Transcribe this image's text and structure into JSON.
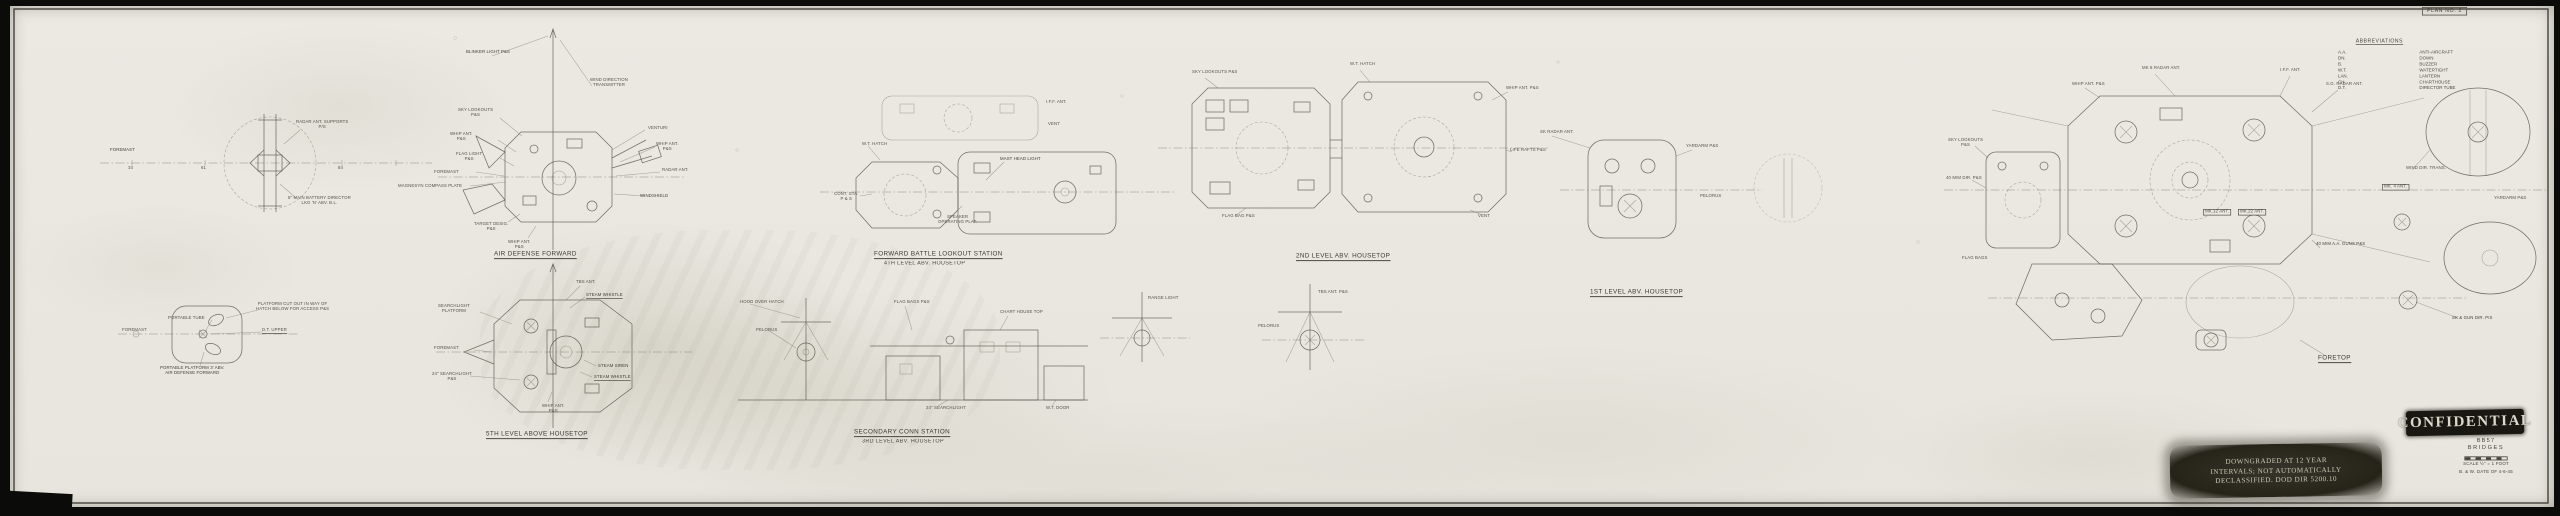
{
  "sheet": {
    "plan_no": "PLAN NO. 2"
  },
  "abbreviations": {
    "title": "ABBREVIATIONS",
    "rows": [
      {
        "abbr": "A.A.",
        "meaning": "ANTI-AIRCRAFT"
      },
      {
        "abbr": "DN.",
        "meaning": "DOWN"
      },
      {
        "abbr": "B.",
        "meaning": "BUZZER"
      },
      {
        "abbr": "W.T.",
        "meaning": "WATERTIGHT"
      },
      {
        "abbr": "LAN.",
        "meaning": "LANTERN"
      },
      {
        "abbr": "CH.",
        "meaning": "CHARTHOUSE"
      },
      {
        "abbr": "D.T.",
        "meaning": "DIRECTOR TUBE"
      }
    ]
  },
  "stamps": {
    "confidential": "CONFIDENTIAL",
    "downgraded_line1": "DOWNGRADED AT 12 YEAR",
    "downgraded_line2": "INTERVALS; NOT AUTOMATICALLY",
    "downgraded_line3": "DECLASSIFIED. DOD DIR 5200.10"
  },
  "title_block": {
    "ship": "BB57",
    "drawing_title": "BRIDGES",
    "scale_note": "SCALE ½\" = 1 FOOT",
    "date_note": "B. & W. DATE OF 4-6-45"
  },
  "sections": {
    "s1": "AIR DEFENSE FORWARD",
    "s2": "FORWARD BATTLE LOOKOUT STATION",
    "s2b": "4TH LEVEL ABV. HOUSETOP",
    "s3": "2ND LEVEL ABV. HOUSETOP",
    "s4": "1ST LEVEL ABV. HOUSETOP",
    "s5": "5TH LEVEL ABOVE HOUSETOP",
    "s6": "SECONDARY CONN STATION",
    "s6b": "3RD LEVEL ABV. HOUSETOP",
    "s7": "FORETOP"
  },
  "clusters": {
    "a": [
      "FOREMAST",
      "RADAR ANT. SUPPORTS\nP/S",
      "5\" MAIN BATTERY DIRECTOR\nLKG 'N' ABV. B.L.",
      "34",
      "61",
      "84"
    ],
    "b": [
      "BLINKER LIGHT P&S",
      "WIND DIRECTION\nTRANSMITTER",
      "SKY LOOKOUTS\nP&S",
      "WHIP ANT.\nP&S",
      "FLAG LIGHT\nP&S",
      "FOREMAST",
      "MAGNESYN COMPASS PLATE",
      "TARGET DESIG.\nP&S",
      "WHIP ANT.\nP&S",
      "VENTURI",
      "WHIP ANT.\nP&S",
      "RADAR ANT.",
      "WINDSHIELD"
    ],
    "c": [
      "TBS ANT.",
      "STEAM WHISTLE",
      "SEARCHLIGHT\nPLATFORM",
      "FOREMAST",
      "24\" SEARCHLIGHT\nP&S",
      "STEAM SIREN",
      "STEAM WHISTLE",
      "WHIP ANT.\nP&S"
    ],
    "d": [
      "PLATFORM CUT OUT IN WAY OF\nHATCH BELOW FOR ACCESS P&S",
      "PORTABLE TUBE",
      "D.T. UPPER",
      "FOREMAST",
      "PORTABLE PLATFORM 3' ABV.\nAIR DEFENSE FORWARD"
    ],
    "e": [
      "MAST HEAD LIGHT",
      "CONT. STA.\nP & S",
      "SPEAKER\nOPERATING PLAT.",
      "I.F.F. ANT.",
      "VENT",
      "W.T. HATCH"
    ],
    "f": [
      "SKY LOOKOUTS P&S",
      "W.T. HATCH",
      "WHIP ANT. P&S",
      "LIFE RAFTS P&S",
      "VENT",
      "FLAG BAG P&S"
    ],
    "g": [
      "SK RADAR ANT.",
      "YARDARM P&S",
      "PELORUS"
    ],
    "h": [
      "HOOD OVER HATCH",
      "PELORUS",
      "FLAG BAGS P&S",
      "CHART HOUSE TOP",
      "24\" SEARCHLIGHT",
      "W.T. DOOR"
    ],
    "i": [
      "RANGE LIGHT"
    ],
    "j": [
      "PELORUS",
      "TBS ANT. P&S"
    ],
    "k": [
      "MK 8 RADAR ANT.",
      "I.F.F. ANT.",
      "S.G. RADAR ANT.",
      "WHIP ANT. P&S",
      "SKY LOOKOUTS\nP&S",
      "40 M/M DIR. P&S",
      "FLAG BAGS",
      "40 M/M A.A. GUNS P&S",
      "SK & GUN DIR. P/S",
      "WIND DIR. TRANS.",
      "MK.12 ANT.",
      "MK.22 ANT.",
      "MK. 4 ANT.",
      "YARDARM P&S"
    ]
  }
}
